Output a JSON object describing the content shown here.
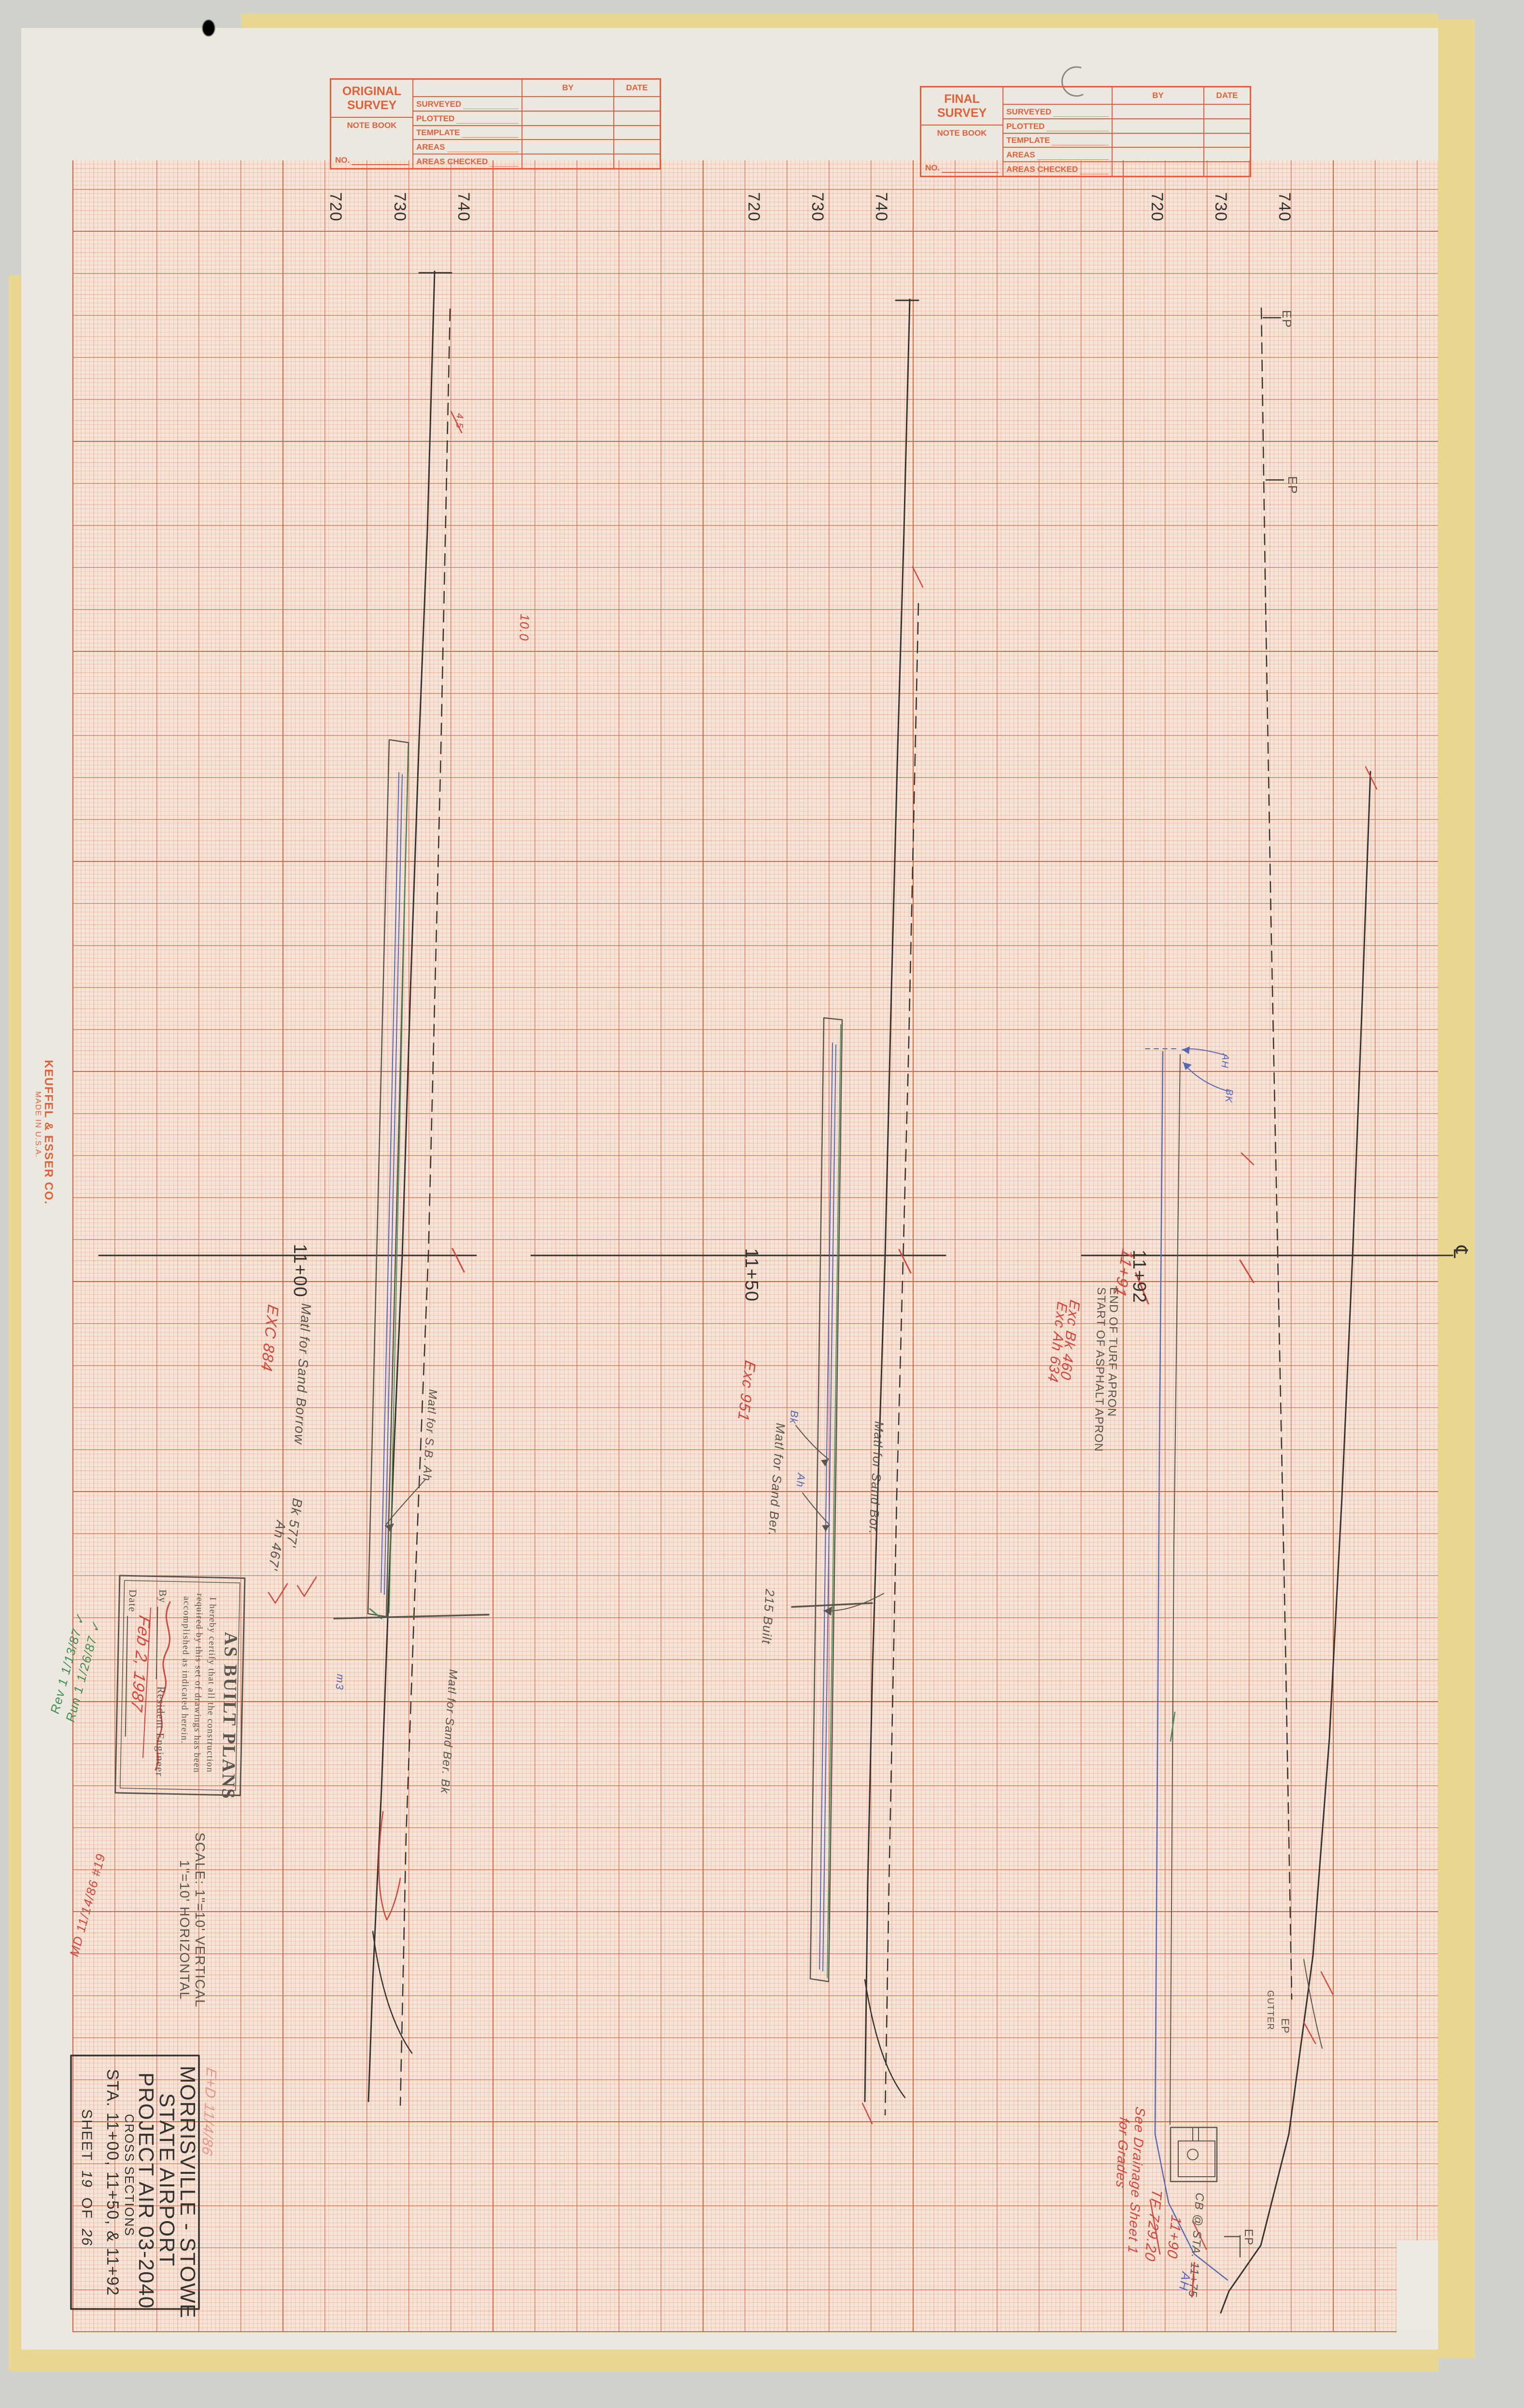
{
  "colors": {
    "grid_orange": "#e8744e",
    "stamp_orange": "#e2603a",
    "red": "#d4453c",
    "blue": "#5468b4",
    "green": "#3f8f56",
    "pencil": "#5a554d",
    "black": "#35332f"
  },
  "survey_stamps": {
    "original_title": "ORIGINAL SURVEY",
    "final_title": "FINAL SURVEY",
    "note_book": "NOTE BOOK",
    "no_label": "NO.",
    "col_by": "BY",
    "col_date": "DATE",
    "rows": [
      "SURVEYED",
      "PLOTTED",
      "TEMPLATE",
      "AREAS",
      "AREAS CHECKED"
    ]
  },
  "elevations": {
    "e720": "720",
    "e730": "730",
    "e740": "740"
  },
  "sections": {
    "s1": {
      "station": "11+00",
      "exc": "EXC 884",
      "matl_borrow": "Matl for Sand Borrow",
      "bk": "Bk 577'",
      "ah": "Ah 467'",
      "check": "✓",
      "matl_sb": "Matl for S.B. Ah",
      "matl_ber": "Matl for Sand Ber. Bk",
      "m3": "m3",
      "r100": "10.0",
      "r45": "4.5"
    },
    "s2": {
      "station": "11+50",
      "exc": "Exc 951",
      "bk": "Bk",
      "ah": "Ah",
      "matl_ber": "Matl for Sand Ber.",
      "built": "215 Built",
      "matl_bor": "Matl for Sand Bor."
    },
    "s3": {
      "station": "11+92",
      "sta_red": "11+91",
      "end_turf": "END OF TURF APRON",
      "start_asphalt": "START OF ASPHALT APRON",
      "exc_bk": "Exc Bk 460",
      "exc_ah": "Exc Ah 634",
      "ep": "EP",
      "gutter": "GUTTER",
      "cb_label": "CB @ STA.",
      "cb_old": "11+75",
      "cb_new": "11+90",
      "tf": "TF 729.20",
      "see_drainage": "See Drainage Sheet 1",
      "for_grades": "for Grades",
      "ah_blue": "AH",
      "bk_blue": "BK",
      "cl": "℄"
    }
  },
  "title_block": {
    "line1": "MORRISVILLE - STOWE",
    "line2": "STATE AIRPORT",
    "line3": "PROJECT AIR 03-2040",
    "line4": "CROSS SECTIONS",
    "line5": "STA. 11+00, 11+50, & 11+92",
    "sheet_prefix": "SHEET",
    "sheet_no": "19",
    "of": "OF",
    "sheet_total": "26"
  },
  "scale_note": {
    "line1": "SCALE: 1\"=10' VERTICAL",
    "line2": "1\"=10' HORIZONTAL"
  },
  "as_built": {
    "title": "AS BUILT PLANS",
    "cert1": "I hereby certify that all the construction",
    "cert2": "required by this set of drawings has been",
    "cert3": "accomplished as indicated herein.",
    "by_label": "By",
    "resident": "Resident Engineer",
    "date_label": "Date",
    "date_value": "Feb 2, 1987"
  },
  "margin_notes": {
    "green1": "Rev 1 1/13/87 ✓",
    "green2": "Run 1 1/26/87 ✓",
    "red1": "MD 11/14/86 #19",
    "faint_red": "E+D 11/4/86"
  },
  "brand": {
    "line1": "KEUFFEL & ESSER CO.",
    "line2": "MADE IN U.S.A."
  }
}
